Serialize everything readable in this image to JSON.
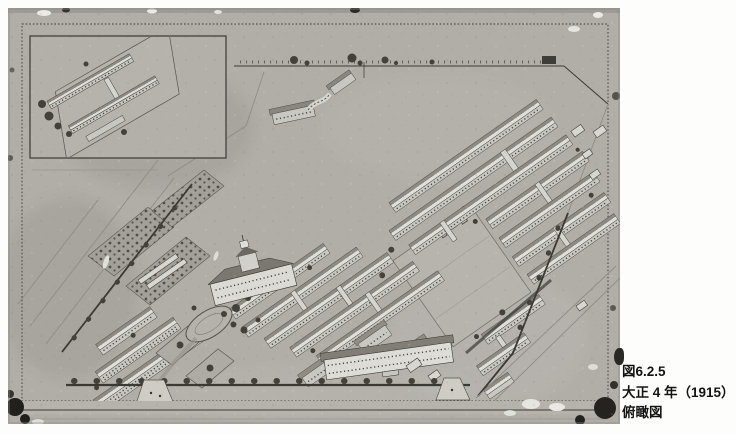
{
  "caption": {
    "line1": "図6.2.5",
    "line2": "大正 4 年（1915）",
    "line3": "俯瞰図"
  }
}
